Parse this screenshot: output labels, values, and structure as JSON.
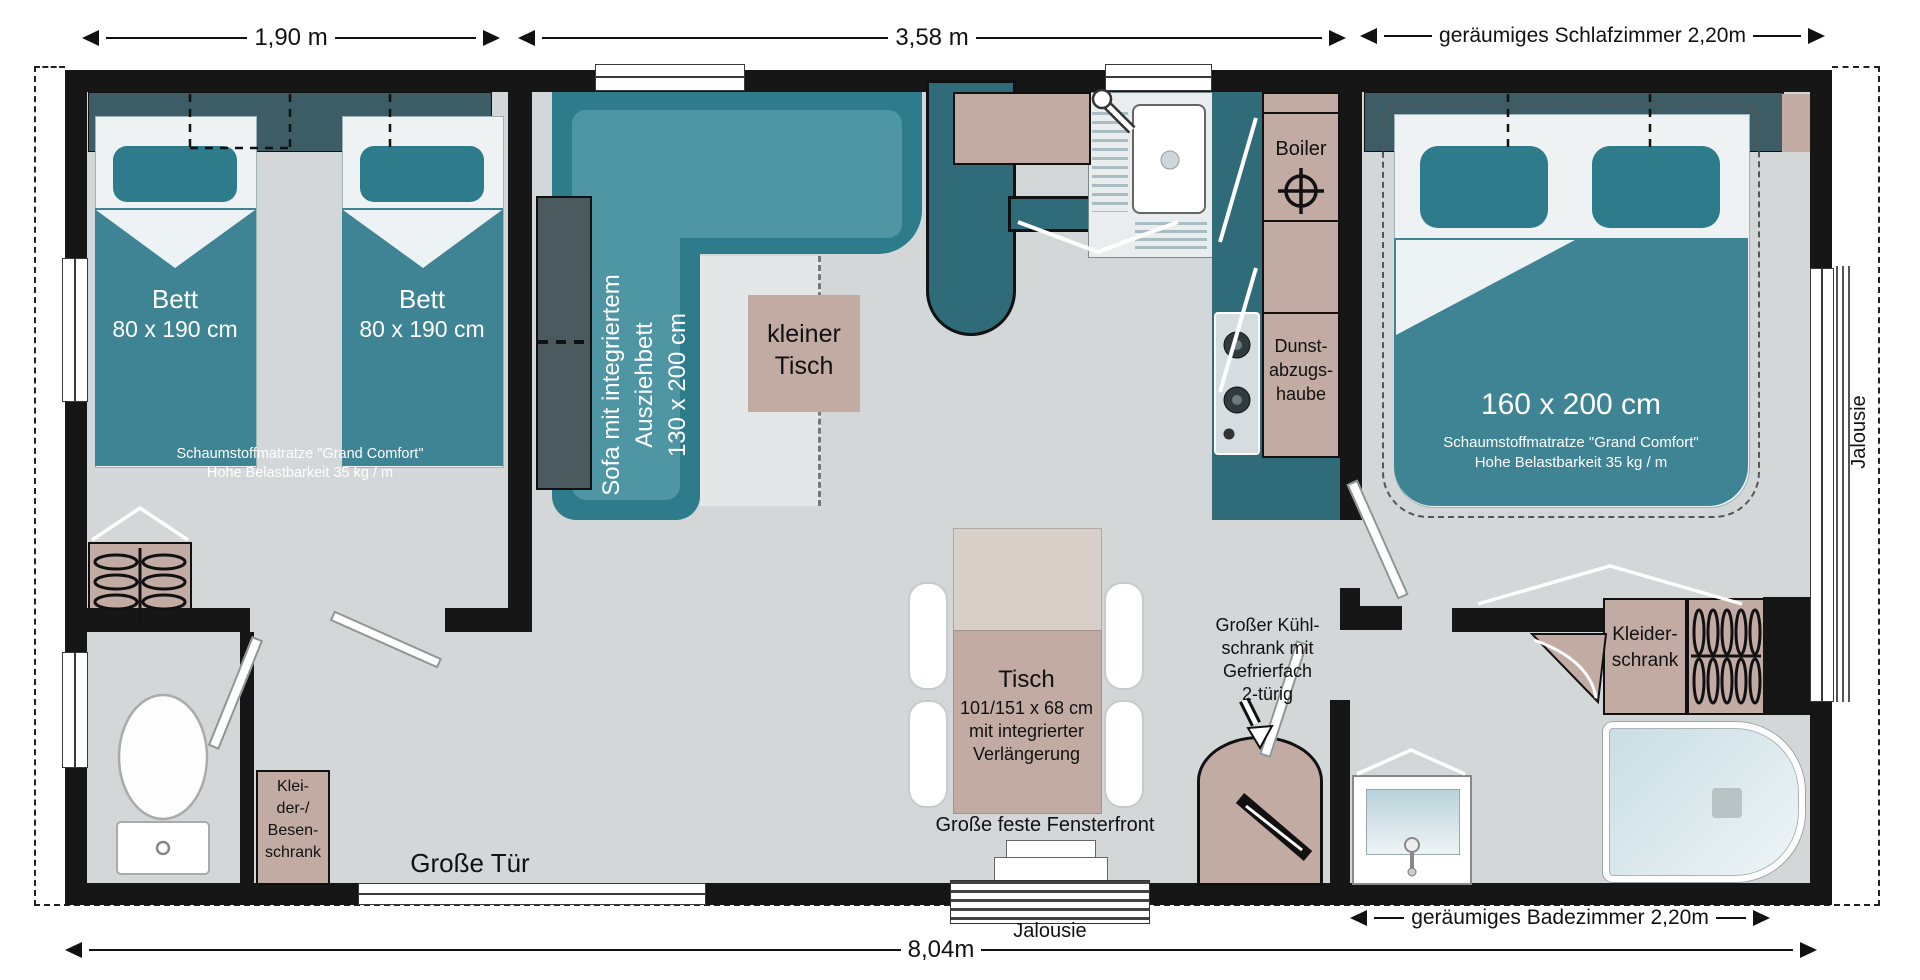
{
  "title": "Mobilheim Grundriss",
  "colors": {
    "wall": "#161616",
    "floor": "#d3d7d8",
    "teal_bed": "#3f8494",
    "teal_dark": "#2e7b8b",
    "teal_headboard": "#3c5d65",
    "teal_light": "#4f96a4",
    "teal_partition": "#2f6b79",
    "beige": "#c2aba3",
    "beige_light": "#d8cfc9",
    "tub_blue": "#c9dde3"
  },
  "plan": {
    "dims": {
      "d1": "1,90 m",
      "d2": "3,58 m",
      "d3": "geräumiges Schlafzimmer 2,20m",
      "d4": "geräumiges Badezimmer 2,20m",
      "d5": "8,04m"
    },
    "labels": {
      "jalousie_side": "Jalousie",
      "jalousie_bottom": "Jalousie",
      "door": "Große Tür",
      "window_front": "Große feste Fensterfront"
    },
    "bedroom_left": {
      "bed1_name": "Bett",
      "bed1_size": "80 x 190 cm",
      "bed2_name": "Bett",
      "bed2_size": "80 x 190 cm",
      "note1": "Schaumstoffmatratze \"Grand Comfort\"",
      "note2": "Hohe Belastbarkeit 35 kg / m",
      "closet1": "Klei-",
      "closet2": "der-/",
      "closet3": "Besen-",
      "closet4": "schrank"
    },
    "living": {
      "sofa1": "Sofa mit integriertem",
      "sofa2": "Ausziehbett",
      "sofa3": "130 x 200 cm",
      "small_table1": "kleiner",
      "small_table2": "Tisch",
      "table1": "Tisch",
      "table2": "101/151 x 68 cm",
      "table3": "mit integrierter",
      "table4": "Verlängerung"
    },
    "kitchen": {
      "boiler": "Boiler",
      "hood1": "Dunst-",
      "hood2": "abzugs-",
      "hood3": "haube",
      "fridge1": "Großer Kühl-",
      "fridge2": "schrank mit",
      "fridge3": "Gefrierfach",
      "fridge4": "2-türig"
    },
    "bedroom_right": {
      "size": "160 x 200 cm",
      "note1": "Schaumstoffmatratze \"Grand Comfort\"",
      "note2": "Hohe Belastbarkeit 35 kg / m",
      "wardrobe1": "Kleider-",
      "wardrobe2": "schrank"
    }
  }
}
